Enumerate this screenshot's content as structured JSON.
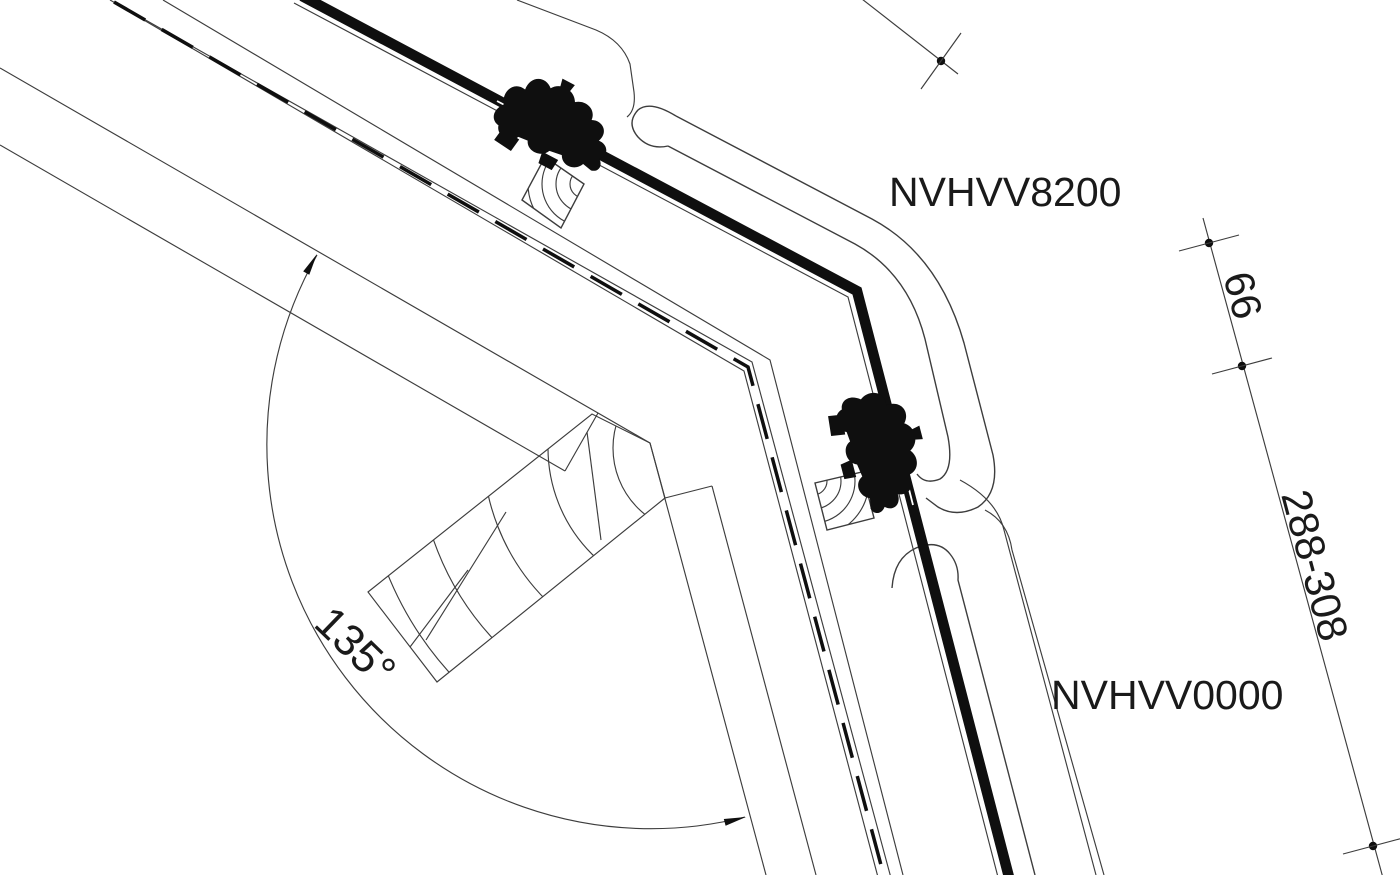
{
  "diagram": {
    "type": "technical-section-drawing",
    "description": "Roof window combi flashing cross-section with 135 degree joint",
    "labels": {
      "upper_flashing": "NVHVV8200",
      "lower_flashing": "NVHVV0000",
      "angle": "135°",
      "dim_upper": "66",
      "dim_lower": "288-308"
    },
    "colors": {
      "background": "#ffffff",
      "thin_line": "#3d3d3d",
      "ink": "#0f0f0f",
      "text": "#1a1a1a"
    }
  }
}
